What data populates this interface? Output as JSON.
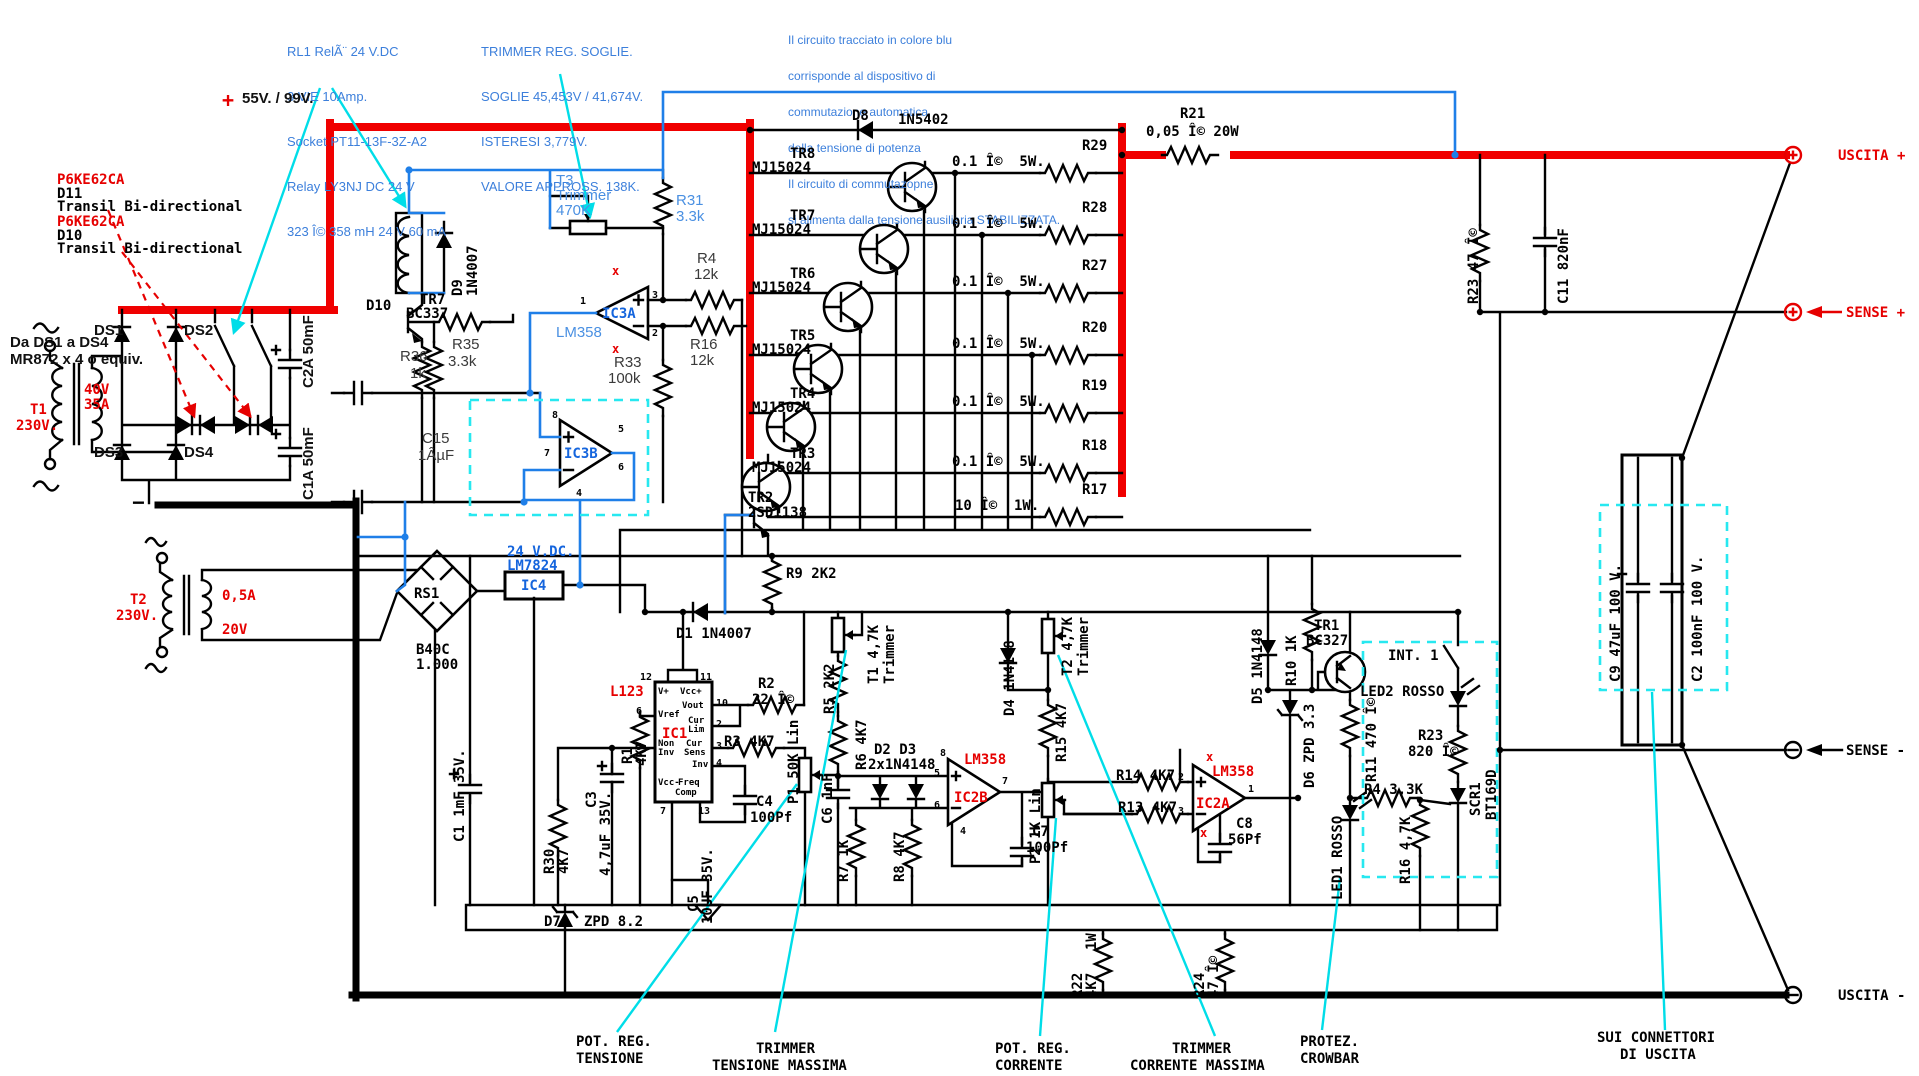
{
  "schematic_title": "Alimentatore stabilizzato 55V/99V - schema elettrico",
  "colors": {
    "power_bus": "#f00000",
    "minus_bus": "#000000",
    "control_wire": "#1f7fe8",
    "annotation_text": "#3c7fdb",
    "leader": "#00dde8",
    "highlight_dashed": "#27e8f0"
  },
  "notes": {
    "relay": [
      "RL1 RelÃ¨ 24 V.DC",
      "3 VIE 10Amp.",
      "Socket PT11-13F-3Z-A2",
      "Relay LY3NJ DC 24 V",
      "323 Î© 358 mH 24 V 60 mA"
    ],
    "trimmer": [
      "TRIMMER REG. SOGLIE.",
      "SOGLIE 45,453V / 41,674V.",
      "ISTERESI 3,779V.",
      "VALORE APPROSS. 138K."
    ],
    "blue_circuit": [
      "Il circuito tracciato in colore blu",
      "corrisponde al dispositivo di",
      "commutazione automatica",
      "della tensione di potenza",
      "Il circuito di commutazopne",
      "si alimenta dalla tensione ausiliaria STABILIZZATA."
    ]
  },
  "labels": {
    "p6ke": "P6KE62CA",
    "d11": "D11",
    "transil": "Transil Bi-directional",
    "d10n": "D10",
    "da_ds": "Da DS1 a DS4",
    "mr872": "MR872 x 4 o equiv.",
    "ds1": "DS1",
    "ds2": "DS2",
    "ds3": "DS3",
    "ds4": "DS4",
    "t1": "T1",
    "t2": "T2",
    "v230": "230V.",
    "v40": "40V",
    "a35": "35A",
    "a05": "0,5A",
    "v20": "20V",
    "c2a": "C2A 50mF",
    "c1a": "C1A 50mF",
    "minus": "−",
    "plus": "+",
    "v5599": "55V. / 99V.",
    "rs1": "RS1",
    "b40c": "B40C",
    "b40c2": "1.000",
    "vdc24": "24 V.DC.",
    "lm7824": "LM7824",
    "ic4": "IC4",
    "d9": "D9",
    "n1n4007": "1N4007",
    "tr7": "TR7",
    "bc337": "BC337",
    "r36": "R36",
    "k1": "1k",
    "r35": "R35",
    "k33": "3.3k",
    "t3": "T3",
    "trimmer": "Trimmer",
    "k470": "470K",
    "r31": "R31",
    "ic3a": "IC3A",
    "lm358": "LM358",
    "x": "x",
    "r4": "R4",
    "k12": "12k",
    "r16": "R16",
    "r33": "R33",
    "k100": "100k",
    "c15": "C15",
    "uf1": "1ÂµF",
    "ic3b": "IC3B",
    "d8": "D8",
    "n1n5402": "1N5402",
    "mj": "MJ15024",
    "tr8": "TR8",
    "tr6": "TR6",
    "tr5": "TR5",
    "tr4": "TR4",
    "tr3": "TR3",
    "tr2": "TR2",
    "sd1138": "2SD1138",
    "r29": "R29",
    "r28": "R28",
    "r27": "R27",
    "r20": "R20",
    "r19": "R19",
    "r18": "R18",
    "r17": "R17",
    "ohm01": "0.1 Î©  5W.",
    "ohm10": "10 Î©  1W.",
    "r21": "R21",
    "r21v": "0,05 Î© 20W",
    "r23t": "R23 47 Î©",
    "c11": "C11 820nF",
    "uscita_p": "USCITA +",
    "sense_p": "SENSE +",
    "sense_m": "SENSE -",
    "uscita_m": "USCITA -",
    "r9": "R9 2K2",
    "d1": "D1 1N4007",
    "l123": "L123",
    "ic1": "IC1",
    "vp": "V+",
    "vccp": "Vcc+",
    "vref": "Vref",
    "vout": "Vout",
    "cur": "Cur",
    "lim": "Lim",
    "sens": "Sens",
    "non": "Non",
    "inv": "Inv",
    "vccm": "Vcc-",
    "freq": "Freq",
    "comp": "Comp",
    "n1": "1",
    "n2": "2",
    "n3": "3",
    "n4": "4",
    "n5": "5",
    "n6": "6",
    "n7": "7",
    "n8": "8",
    "n10": "10",
    "n11": "11",
    "n12": "12",
    "n13": "13",
    "r1": "R1",
    "k47": "4K7",
    "r2": "R2",
    "ohm22": "22 Î©",
    "r3": "R3 4K7",
    "c4": "C4",
    "pf100": "100Pf",
    "r30": "R30",
    "c3": "C3",
    "c3v": "4,7uF 35V.",
    "d7": "D7",
    "zpd82": "ZPD 8.2",
    "c1": "C1 1mF 35V.",
    "c5": "C5",
    "c5v": "10UF 35V.",
    "p1": "P1 50K Lin",
    "c6": "C6 1nF",
    "r5": "R5 2K2",
    "r6": "R6 4K7",
    "t1t": "T1 4,7K",
    "d2d3": "D2 D3",
    "d2d3v": "2x1N4148",
    "ic2b": "IC2B",
    "r7": "R7 1K",
    "r8": "R8 4K7",
    "c7": "C7",
    "p2": "P2 1K Lin",
    "d4": "D4 1N4148",
    "t2t": "T2 4,7K",
    "r15": "R15 4K7",
    "r14": "R14 4K7",
    "r13": "R13 4K7",
    "ic2a": "IC2A",
    "c8": "C8",
    "pf56": "56Pf",
    "d5": "D5 1N4148",
    "r10": "R10 1K",
    "d6": "D6 ZPD 3.3",
    "tr1": "TR1",
    "bc327": "BC327",
    "r11": "R11 470 Î©",
    "led1": "LED1 ROSSO",
    "led2": "LED2 ROSSO",
    "r23b": "R23",
    "ohm820": "820 Î©",
    "r4b": "R4 3,3K",
    "r16b": "R16 4,7K",
    "scr1": "SCR1",
    "bt169": "BT169D",
    "int1": "INT. 1",
    "r22": "R22",
    "w1": "1W",
    "r24": "R24",
    "ohm47": "47 Î©",
    "c9": "C9 47uF 100 V.",
    "c2": "C2 100nF 100 V.",
    "pot_reg": "POT. REG.",
    "tensione": "TENSIONE",
    "trimmer_u": "TRIMMER",
    "tens_max": "TENSIONE MASSIMA",
    "corrente": "CORRENTE",
    "corr_max": "CORRENTE MASSIMA",
    "protez": "PROTEZ.",
    "crowbar": "CROWBAR",
    "sui": "SUI CONNETTORI",
    "di_uscita": "DI USCITA"
  }
}
